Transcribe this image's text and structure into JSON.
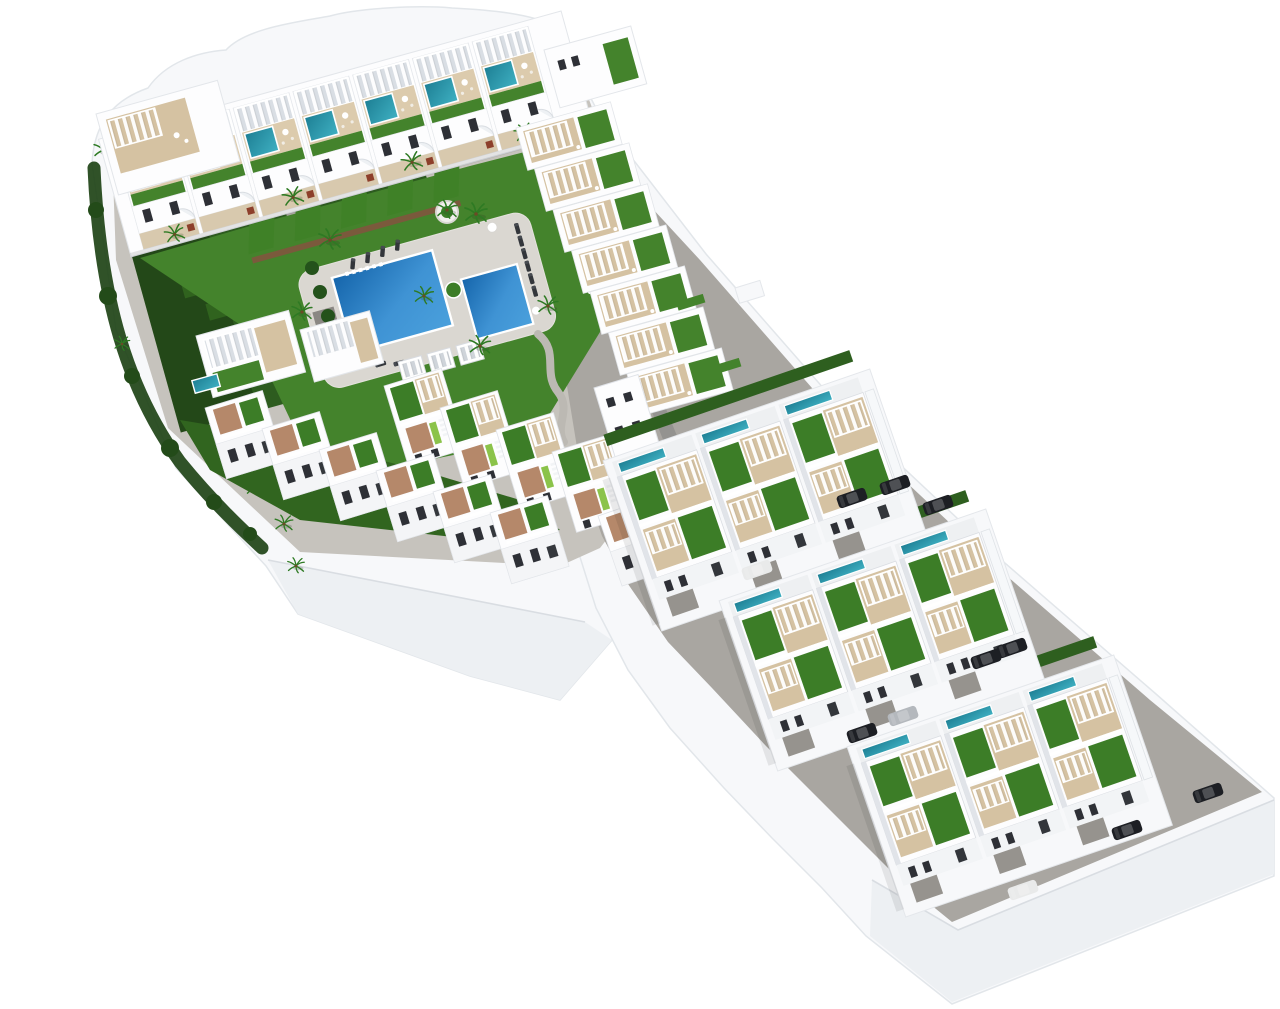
{
  "scene": {
    "label": "Aerial 3D architectural rendering of a white residential development: an apartment complex with communal pool and gardens plus three staggered rows of detached villas with roof terraces, on a white model base",
    "style": "isometric 3D render on plain white background",
    "no_visible_text": true
  },
  "palette": {
    "background": "#ffffff",
    "slab": "#f7f8fa",
    "slab-face": "#edf0f3",
    "edge": "#e2e6ea",
    "road": "#a9a6a1",
    "deck": "#c6c3bd",
    "pool-deck": "#dad7d1",
    "walkway": "#d8c9ae",
    "building": "#fdfdfe",
    "wall-shade": "#e1e4e9",
    "window": "#2e3036",
    "lawn": "#44832c",
    "lawn-bright": "#479030",
    "lawn-dark": "#31651f",
    "hedge": "#1e4316",
    "strip-green": "#3f8127",
    "strip-base": "#2d5c1f",
    "pool-blue": "#1565ab",
    "pool-blue-light": "#4aa0dc",
    "teal-pool": "#1d7f94",
    "teal-pool-light": "#3fb0c2",
    "tan-terrace": "#d5c2a2",
    "terracotta": "#b5886a",
    "stone-wall": "#7a5a3c",
    "lime-turf": "#8bc34a",
    "planter": "#8d3f2b",
    "palm": "#2e7a23",
    "car-dark": "#1d1f24",
    "car-white": "#e9eaea",
    "car-silver": "#b4b8bd"
  },
  "inventory": {
    "apartment_roof_terraces": 7,
    "rooftop_plunge_pools": 7,
    "communal_swimming_pools": 2,
    "poolside_cabanas": 3,
    "sun_loungers": 17,
    "villa_clusters": 3,
    "villas_per_cluster": 3,
    "townhouse_units": 12,
    "garden_lawn_strips": 13,
    "palm_trees": 24,
    "parked_cars": {
      "dark": 8,
      "white": 2,
      "silver": 1
    }
  }
}
